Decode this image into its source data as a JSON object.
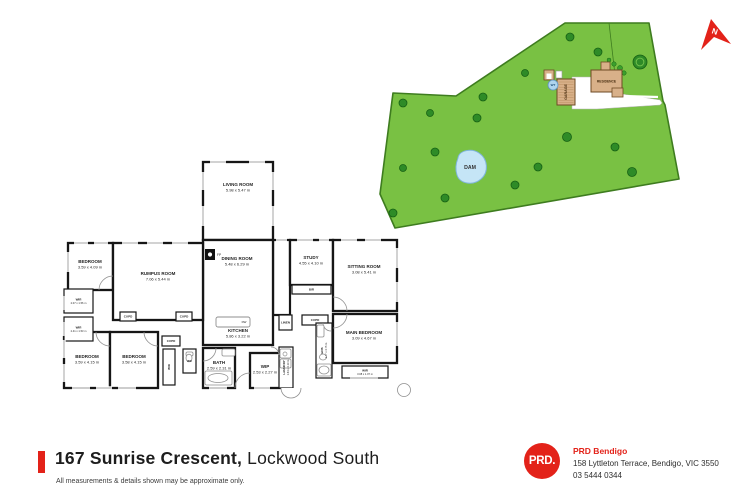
{
  "title": {
    "address_bold": "167 Sunrise Crescent,",
    "address_light": "Lockwood South",
    "disclaimer": "All measurements & details shown may be approximate only."
  },
  "agency": {
    "logo_text": "PRD.",
    "name": "PRD Bendigo",
    "address": "158 Lyttleton Terrace, Bendigo, VIC 3550",
    "phone": "03 5444 0344"
  },
  "colors": {
    "brand_red": "#e32219",
    "land": "#79c143",
    "land_border": "#3e7c1f",
    "tree": "#2e8b27",
    "tree_dark": "#176114",
    "bush": "#3aa02c",
    "ring": "#6fbf4a",
    "dam_fill": "#c5e5f6",
    "dam_stroke": "#7fb5dc",
    "building_fill": "#d8b089",
    "building_stroke": "#6e4a24",
    "hatch": "#b78d5f",
    "wall": "#161616",
    "window_line": "#9b9b9b",
    "fixture": "#8f8f8f",
    "label": "#1f1f1f",
    "wt_fill": "#aed4ee",
    "wt_stroke": "#5f93c0"
  },
  "north": {
    "label": "N",
    "points": "711,19 731,44 714,37 701,50",
    "label_x": 714,
    "label_y": 34,
    "rotate": 18
  },
  "siteplan": {
    "land_points": "565,23 649,23 663,101 665,105 679,179 395,228 380,194 393,93 456,96",
    "fence": [
      609,
      23,
      617,
      92
    ],
    "driveway_points": "572,77 597,77 597,90 660,100 662,103 660,105 597,109 572,109",
    "access_line": [
      622,
      96,
      658,
      97
    ],
    "dam": {
      "label": "DAM",
      "path": "M458,158 C459,150 472,148 479,153 C488,159 489,172 481,179 C473,186 460,184 457,175 C455,169 456,163 458,158 Z",
      "label_x": 470,
      "label_y": 169
    },
    "trees": [
      [
        570,
        37,
        4
      ],
      [
        598,
        52,
        4
      ],
      [
        640,
        62,
        7,
        1
      ],
      [
        525,
        73,
        3.5
      ],
      [
        483,
        97,
        4
      ],
      [
        403,
        103,
        4
      ],
      [
        430,
        113,
        3.5
      ],
      [
        477,
        118,
        4
      ],
      [
        567,
        137,
        4.5
      ],
      [
        615,
        147,
        4
      ],
      [
        435,
        152,
        4
      ],
      [
        403,
        168,
        3.5
      ],
      [
        538,
        167,
        4
      ],
      [
        632,
        172,
        4.5
      ],
      [
        515,
        185,
        4
      ],
      [
        445,
        198,
        4
      ],
      [
        393,
        213,
        4
      ]
    ],
    "bushes": [
      [
        614,
        64,
        2.2
      ],
      [
        620,
        68,
        2.5
      ],
      [
        624,
        73,
        2.2
      ],
      [
        618,
        77,
        2
      ],
      [
        609,
        60,
        2
      ]
    ],
    "shed": {
      "x": 544,
      "y": 70,
      "w": 10,
      "h": 10
    },
    "shed_box": {
      "x": 556,
      "y": 71,
      "w": 6,
      "h": 7
    },
    "garage": {
      "label": "GARAGE",
      "x": 557,
      "y": 79,
      "w": 18,
      "h": 26
    },
    "residence": {
      "label": "RESIDENCE",
      "x": 591,
      "y": 70,
      "w": 31,
      "h": 22,
      "chimney": [
        601,
        62,
        9,
        9
      ],
      "ext": [
        612,
        88,
        11,
        9
      ]
    },
    "wt": {
      "label": "WT",
      "cx": 553,
      "cy": 85,
      "r": 5
    }
  },
  "floorplan": {
    "rooms": [
      {
        "name": "LIVING ROOM",
        "dims": "5.98 x 5.47 m",
        "rect": [
          203,
          162,
          70,
          78
        ],
        "label": [
          238,
          186
        ]
      },
      {
        "name": "DINING ROOM",
        "dims": "5.48 x 6.29 m",
        "rect": [
          203,
          240,
          70,
          105
        ],
        "label": [
          237,
          260
        ]
      },
      {
        "name": "KITCHEN",
        "dims": "5.86 x 3.22 m",
        "rect": null,
        "label": [
          238,
          332
        ]
      },
      {
        "name": "BEDROOM",
        "dims": "3.59 x 4.09 m",
        "rect": [
          68,
          243,
          45,
          47
        ],
        "label": [
          90,
          263
        ]
      },
      {
        "name": "RUMPUS ROOM",
        "dims": "7.06 x 5.44 m",
        "rect": [
          113,
          243,
          90,
          77
        ],
        "label": [
          158,
          275
        ]
      },
      {
        "name": "STUDY",
        "dims": "4.55 x 4.10 m",
        "rect": [
          290,
          240,
          43,
          45
        ],
        "label": [
          311,
          259
        ]
      },
      {
        "name": "SITTING ROOM",
        "dims": "3.08 x 5.41 m",
        "rect": [
          333,
          240,
          64,
          71
        ],
        "label": [
          364,
          268
        ]
      },
      {
        "name": "MAIN BEDROOM",
        "dims": "3.09 x 4.67 m",
        "rect": [
          333,
          314,
          64,
          49
        ],
        "label": [
          364,
          334
        ]
      },
      {
        "name": "BEDROOM",
        "dims": "3.59 x 4.15 m",
        "rect": [
          64,
          332,
          46,
          56
        ],
        "label": [
          87,
          358
        ]
      },
      {
        "name": "BEDROOM",
        "dims": "3.58 x 4.15 m",
        "rect": [
          110,
          332,
          48,
          56
        ],
        "label": [
          134,
          358
        ]
      },
      {
        "name": "BATH",
        "dims": "2.59 x 2.31 m",
        "rect": [
          203,
          348,
          32,
          40
        ],
        "label": [
          219,
          364
        ]
      },
      {
        "name": "WIP",
        "dims": "2.53 x 2.27 m",
        "rect": [
          250,
          353,
          30,
          35
        ],
        "label": [
          265,
          368
        ]
      }
    ],
    "halls": [
      [
        273,
        240,
        17,
        75
      ]
    ],
    "closets": [
      {
        "name": "CUPD",
        "rect": [
          120,
          312,
          16,
          9
        ]
      },
      {
        "name": "CUPD",
        "rect": [
          176,
          312,
          16,
          9
        ]
      },
      {
        "name": "CUPD",
        "rect": [
          162,
          336,
          18,
          10
        ]
      },
      {
        "name": "WIR",
        "rect": [
          163,
          349,
          12,
          36
        ],
        "rot": true
      },
      {
        "name": "WC",
        "rect": [
          183,
          349,
          13,
          24
        ]
      },
      {
        "name": "BIR",
        "rect": [
          292,
          285,
          39,
          9
        ]
      },
      {
        "name": "LINEN",
        "rect": [
          279,
          315,
          13,
          15
        ]
      },
      {
        "name": "CUPD",
        "rect": [
          302,
          315,
          26,
          10
        ]
      },
      {
        "name": "ENS",
        "dims": "1.77 x 4.75 m",
        "rect": [
          316,
          323,
          16,
          55
        ],
        "rot": true
      },
      {
        "name": "LAUNDRY",
        "dims": "1.64 x 4.13 m",
        "rect": [
          279,
          347,
          14,
          41
        ],
        "rot": true
      },
      {
        "name": "WIR",
        "dims": "3.08 x 1.07 m",
        "rect": [
          342,
          366,
          46,
          12
        ]
      },
      {
        "name": "WIR",
        "dims": "2.07 x 1.56 m",
        "rect": [
          64,
          289,
          29,
          24
        ]
      },
      {
        "name": "WIR",
        "dims": "2.41 x 1.53 m",
        "rect": [
          64,
          317,
          29,
          24
        ]
      }
    ],
    "windows": [
      [
        210,
        162,
        226,
        162
      ],
      [
        249,
        162,
        265,
        162
      ],
      [
        203,
        172,
        203,
        190
      ],
      [
        203,
        206,
        203,
        226
      ],
      [
        273,
        172,
        273,
        190
      ],
      [
        273,
        206,
        273,
        226
      ],
      [
        276,
        240,
        287,
        240
      ],
      [
        74,
        243,
        88,
        243
      ],
      [
        94,
        243,
        108,
        243
      ],
      [
        68,
        252,
        68,
        272
      ],
      [
        122,
        243,
        138,
        243
      ],
      [
        147,
        243,
        163,
        243
      ],
      [
        172,
        243,
        188,
        243
      ],
      [
        297,
        240,
        313,
        240
      ],
      [
        319,
        240,
        329,
        240
      ],
      [
        341,
        240,
        357,
        240
      ],
      [
        365,
        240,
        381,
        240
      ],
      [
        397,
        248,
        397,
        268
      ],
      [
        397,
        282,
        397,
        302
      ],
      [
        397,
        322,
        397,
        346
      ],
      [
        350,
        378,
        378,
        378
      ],
      [
        64,
        296,
        64,
        310
      ],
      [
        64,
        322,
        64,
        336
      ],
      [
        64,
        340,
        64,
        358
      ],
      [
        64,
        364,
        64,
        382
      ],
      [
        72,
        388,
        90,
        388
      ],
      [
        96,
        388,
        112,
        388
      ],
      [
        118,
        388,
        136,
        388
      ],
      [
        209,
        388,
        227,
        388
      ],
      [
        254,
        388,
        270,
        388
      ]
    ],
    "doors": [
      "M99,290 A14 14 0 0 1 113,276",
      "M96,332 A14 14 0 0 0 110,346",
      "M144,332 A14 14 0 0 0 158,346",
      "M347,311 A14 14 0 0 0 333,297",
      "M347,314 A14 14 0 0 1 333,328",
      "M203,361 A13 13 0 0 0 216,348",
      "M235,388 A15 15 0 0 1 250,373",
      "M331,331 A8 8 0 0 1 323,323",
      "M279,355 A8 8 0 0 0 271,347"
    ],
    "fireplace": {
      "label": "FP",
      "rect": [
        205,
        249,
        10,
        11
      ]
    },
    "island": {
      "label": "DW",
      "rect": [
        216,
        317,
        34,
        10
      ]
    },
    "fixtures": {
      "rects": [
        [
          222,
          349,
          13,
          7
        ],
        [
          186,
          352,
          7,
          4
        ],
        [
          317,
          325,
          7,
          12
        ],
        [
          280,
          349,
          11,
          9
        ],
        [
          280,
          359,
          11,
          9
        ],
        [
          317,
          364,
          14,
          12
        ],
        [
          205,
          371,
          27,
          14
        ]
      ],
      "ellipses": [
        [
          218,
          378,
          10,
          4.5
        ],
        [
          189,
          358,
          3,
          3.8
        ],
        [
          323,
          357,
          3.5,
          3
        ],
        [
          324,
          370,
          5,
          4
        ]
      ],
      "circles": [
        [
          224,
          322,
          1.4
        ],
        [
          229,
          322,
          1.4
        ],
        [
          285,
          354,
          2
        ]
      ]
    },
    "porch": "M281,388 A10 10 0 0 0 301,388",
    "tank_circle": [
      404,
      390,
      6.5
    ]
  }
}
